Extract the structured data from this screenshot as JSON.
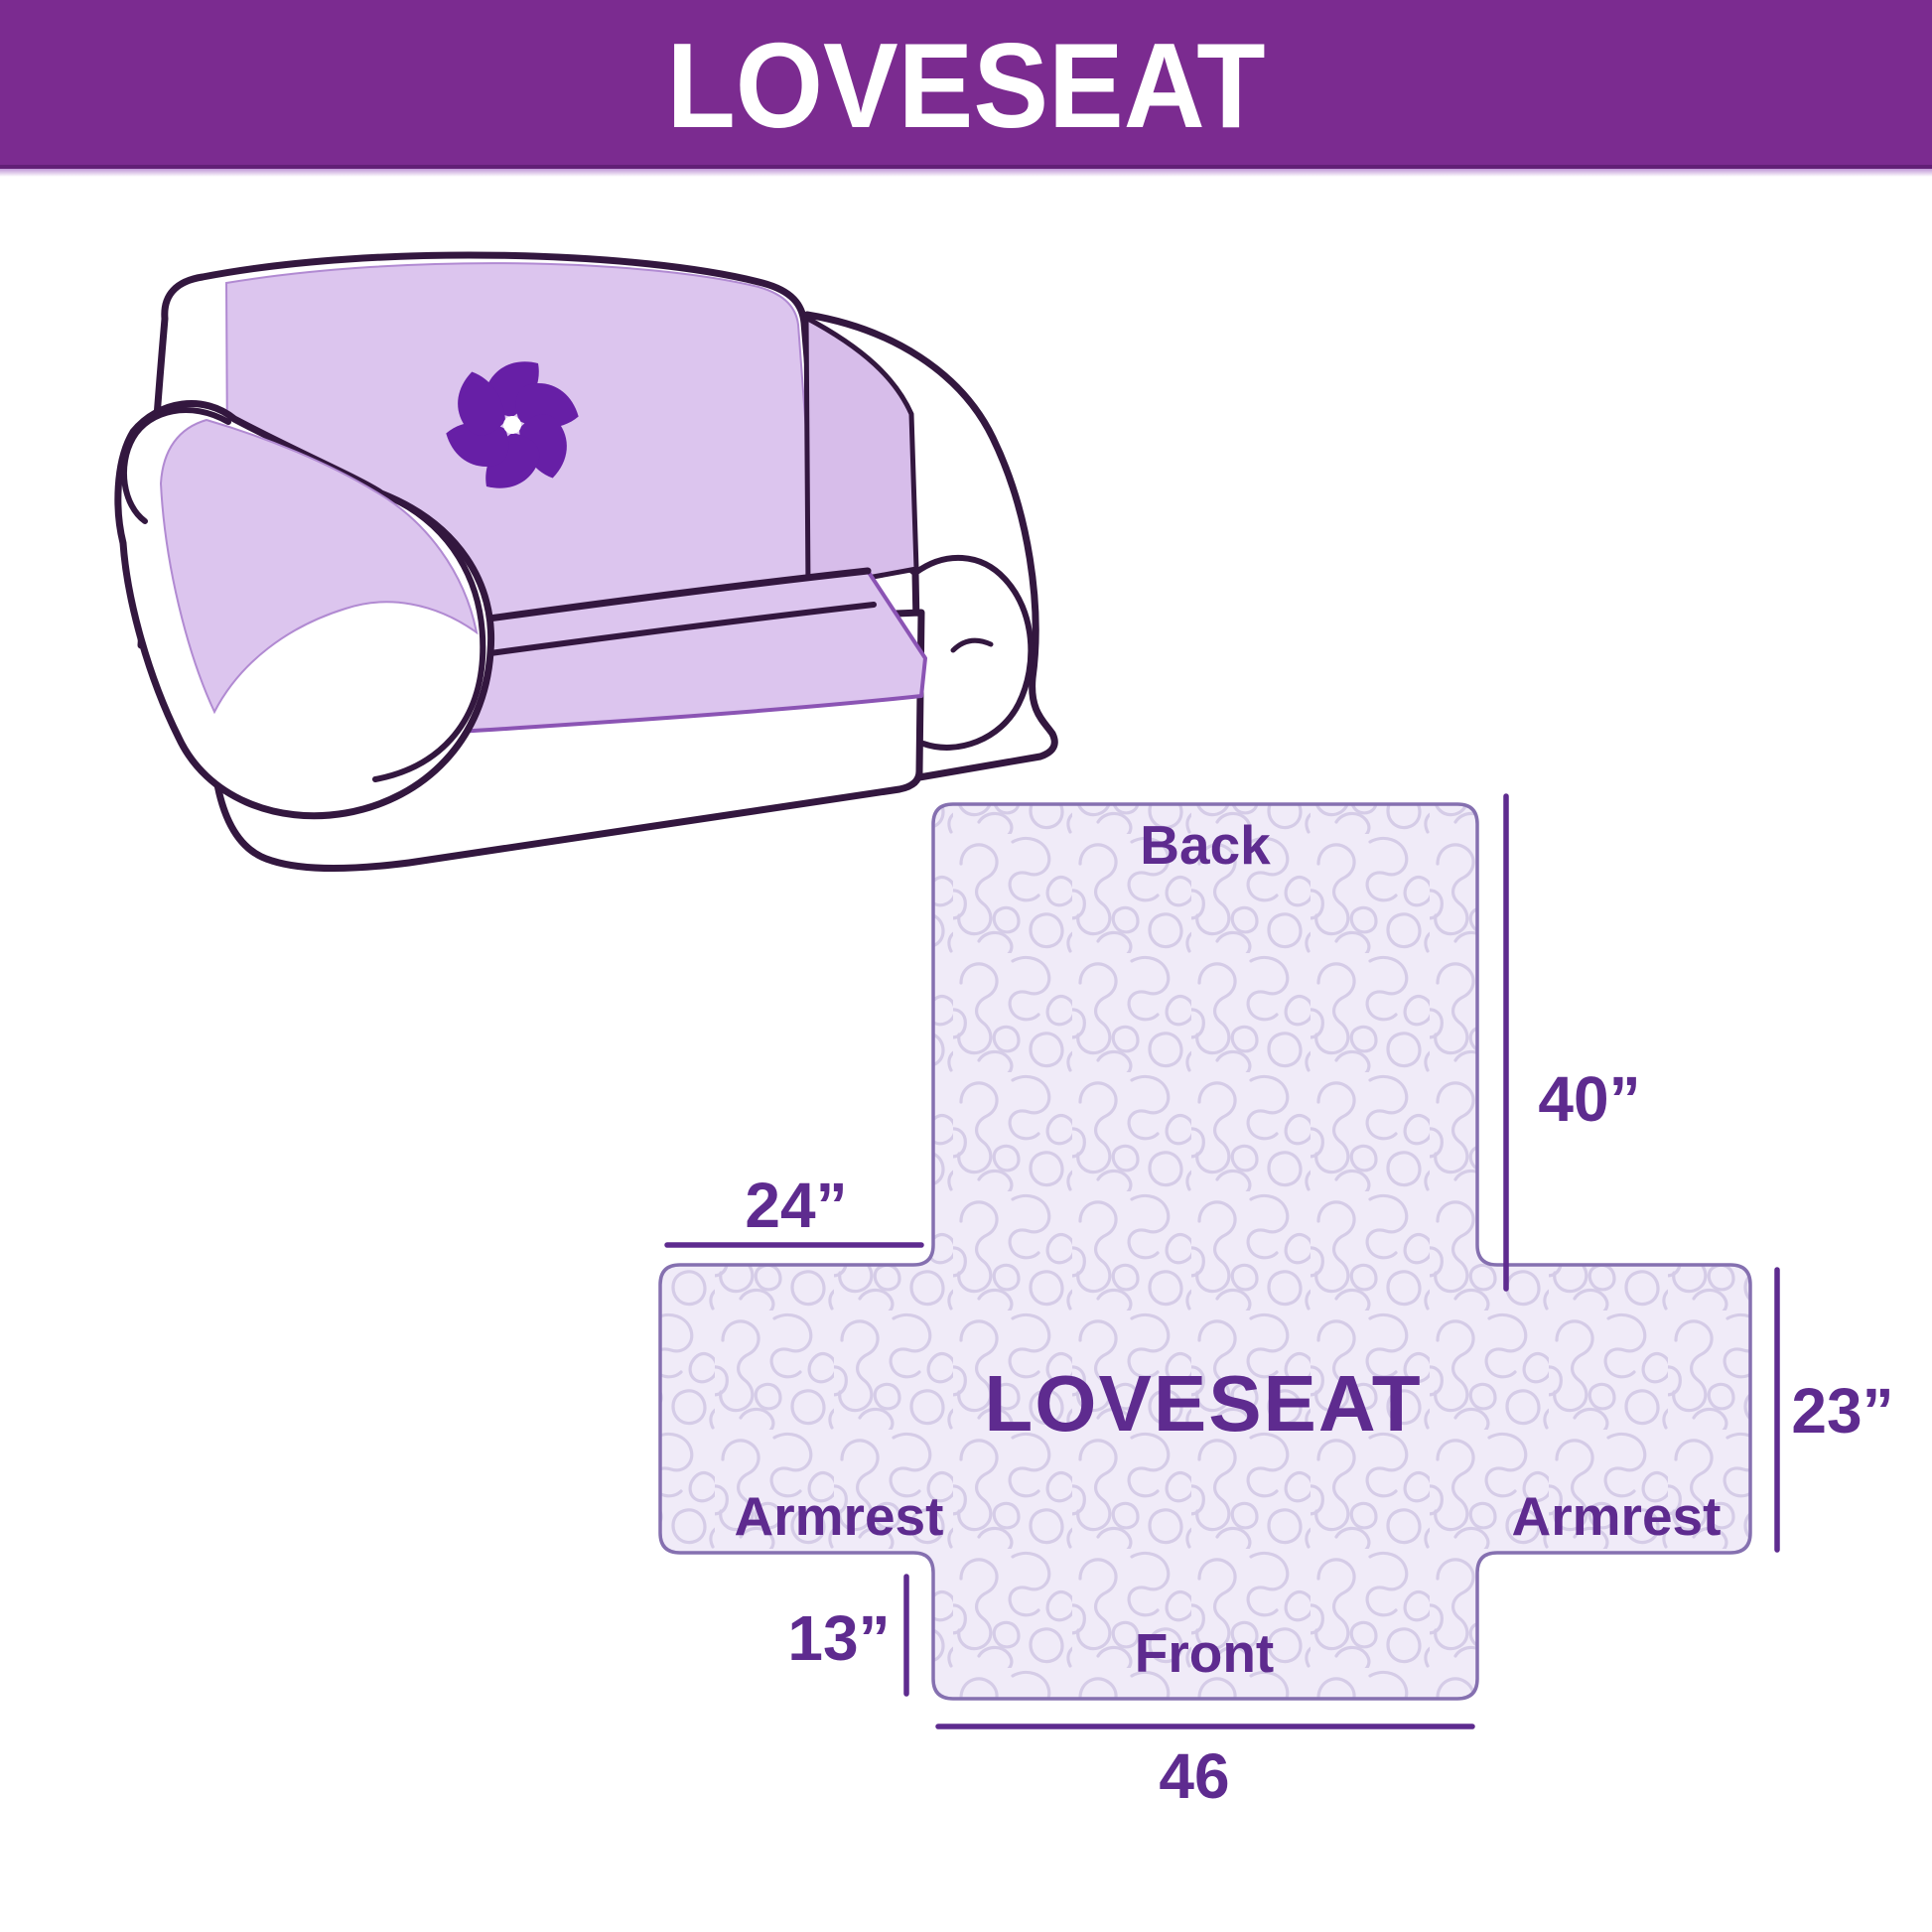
{
  "header": {
    "title": "LOVESEAT"
  },
  "illustration": {
    "alt": "loveseat sofa with quilted slipcover",
    "logo_icon": "pinwheel-icon"
  },
  "diagram": {
    "center_label": "LOVESEAT",
    "back_label": "Back",
    "front_label": "Front",
    "armrest_left_label": "Armrest",
    "armrest_right_label": "Armrest",
    "dimensions": {
      "back_side_width": "24”",
      "back_height": "40”",
      "armrest_height": "23”",
      "front_skirt_height": "13”",
      "front_width": "46"
    }
  },
  "colors": {
    "banner": "#7b2b90",
    "banner_separator": "#bf96d6",
    "title_text": "#ffffff",
    "label_purple": "#5e2b8f",
    "dimension_line": "#5e2b8f",
    "cover_lavender": "#dcc5ee",
    "outline_dark": "#33173f",
    "logo_purple": "#671fa6",
    "quilt_fill": "#f0ebf8",
    "quilt_line": "#d5cce7",
    "diagram_border": "#8570b0"
  }
}
